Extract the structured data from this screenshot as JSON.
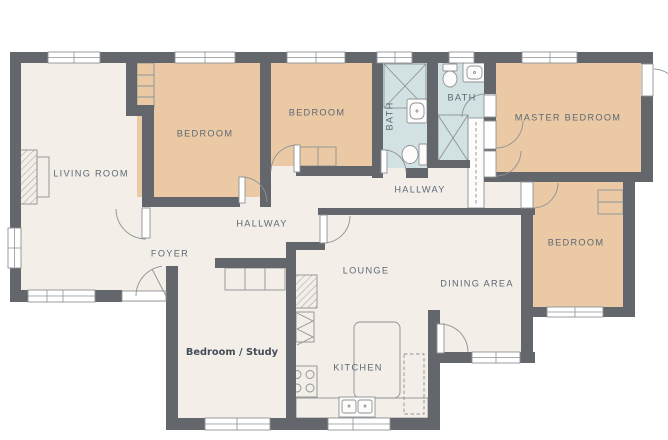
{
  "floorplan": {
    "rooms": [
      {
        "id": "living-room",
        "label": "LIVING ROOM"
      },
      {
        "id": "bedroom-1",
        "label": "BEDROOM"
      },
      {
        "id": "bedroom-2",
        "label": "BEDROOM"
      },
      {
        "id": "bath-1",
        "label": "BATH"
      },
      {
        "id": "bath-2",
        "label": "BATH"
      },
      {
        "id": "master-bedroom",
        "label": "MASTER BEDROOM"
      },
      {
        "id": "hallway-upper",
        "label": "HALLWAY"
      },
      {
        "id": "hallway-lower",
        "label": "HALLWAY"
      },
      {
        "id": "foyer",
        "label": "FOYER"
      },
      {
        "id": "lounge",
        "label": "LOUNGE"
      },
      {
        "id": "dining-area",
        "label": "DINING AREA"
      },
      {
        "id": "bedroom-3",
        "label": "BEDROOM"
      },
      {
        "id": "kitchen",
        "label": "KITCHEN"
      },
      {
        "id": "bedroom-study",
        "label": "Bedroom / Study"
      }
    ],
    "colors": {
      "wall": "#63676b",
      "floor": "#f4eee8",
      "bedroom_floor": "#ebc9a4",
      "bath_floor": "#d2e2e2",
      "shower_fill": "#dcebeb",
      "label": "#5c6875",
      "annotation": "#414c57",
      "fixture_line": "#8d9296"
    }
  }
}
